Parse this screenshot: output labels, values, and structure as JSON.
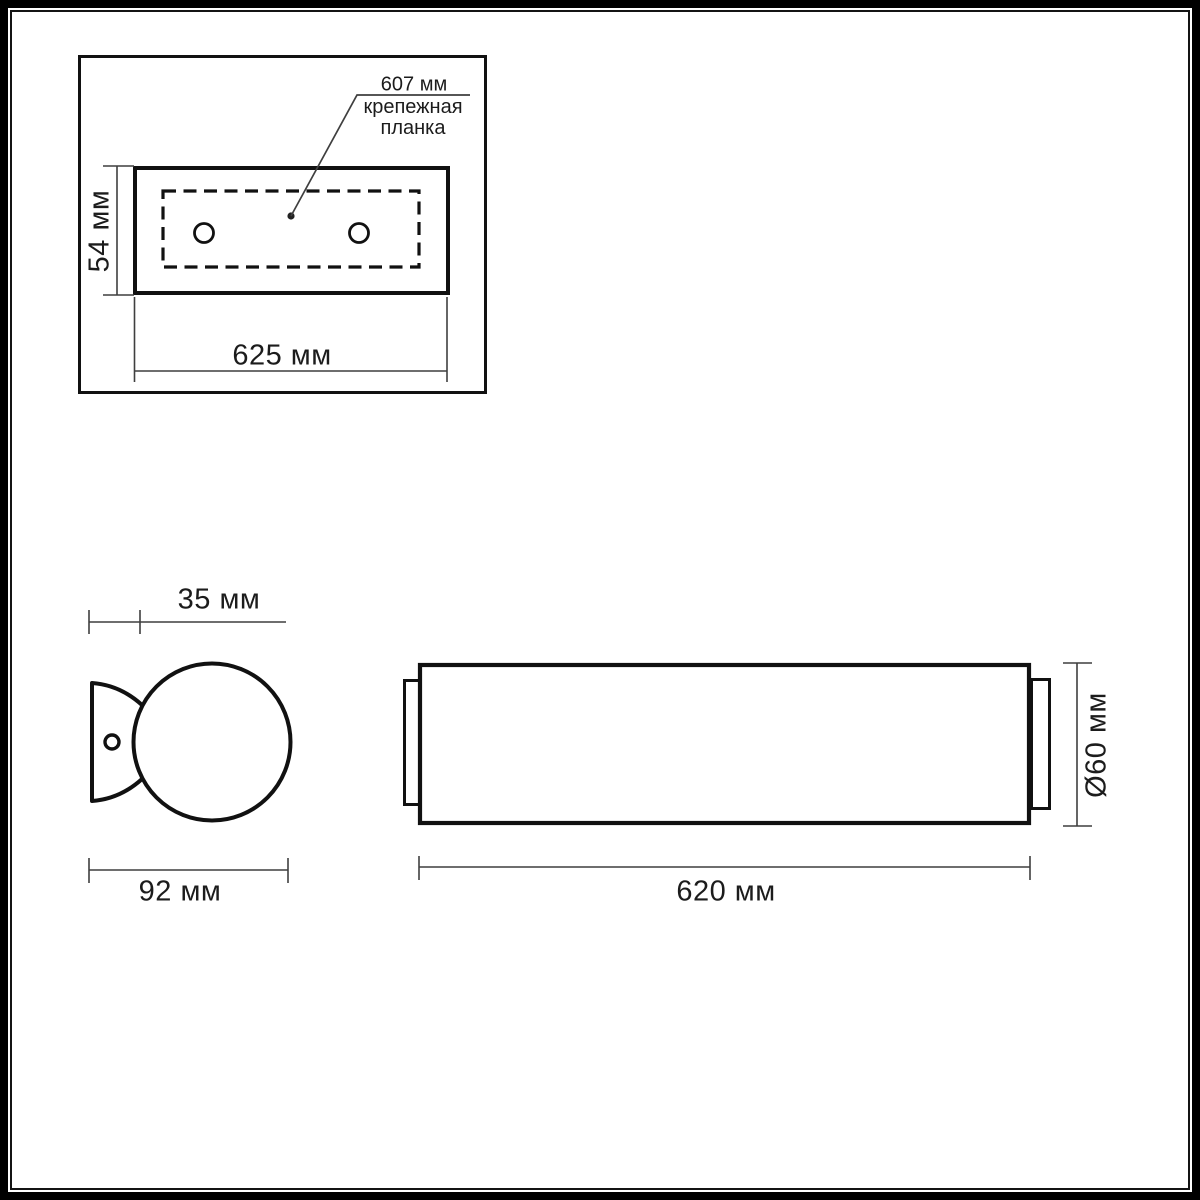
{
  "drawing_title": "wall-lamp dimensional drawing",
  "labels": {
    "plate_length": "607 мм",
    "plate_name_line1": "крепежная",
    "plate_name_line2": "планка",
    "plate_height": "54 мм",
    "plate_width": "625 мм",
    "bracket_depth": "35 мм",
    "bracket_width": "92 мм",
    "body_length": "620 мм",
    "body_diameter": "Ø60 мм"
  },
  "colors": {
    "background": "#ffffff",
    "outline": "#111111",
    "dimension_lines": "#3f3f3f",
    "text": "#1c1c1c"
  }
}
